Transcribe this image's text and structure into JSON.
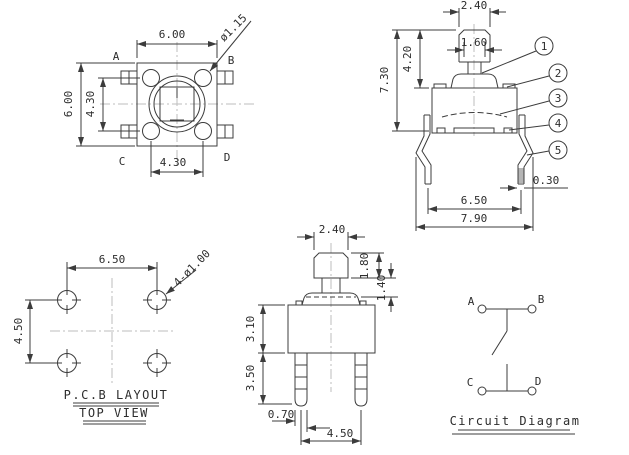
{
  "meta": {
    "background": "#ffffff",
    "line_color": "#3c3c3c",
    "centerline_color": "#bdbdbd"
  },
  "top_view": {
    "dim_width": "6.00",
    "dim_height": "6.00",
    "dim_pin_vertical": "4.30",
    "dim_pin_horizontal": "4.30",
    "button_diameter": "ø1.15",
    "pin_a": "A",
    "pin_b": "B",
    "pin_c": "C",
    "pin_d": "D"
  },
  "side_view": {
    "dim_cap_width": "2.40",
    "dim_stem_width": "1.60",
    "dim_stem_height": "4.20",
    "dim_total_height": "7.30",
    "dim_leg_thickness": "0.30",
    "dim_leg_span": "6.50",
    "dim_total_width": "7.90",
    "callout_1": "1",
    "callout_2": "2",
    "callout_3": "3",
    "callout_4": "4",
    "callout_5": "5"
  },
  "pcb_view": {
    "dim_hole_span_h": "6.50",
    "dim_hole_span_v": "4.50",
    "hole_note": "4-ø1.00",
    "title": "P.C.B LAYOUT",
    "subtitle": "TOP VIEW"
  },
  "front_view": {
    "dim_cap_width": "2.40",
    "dim_cap_height": "1.80",
    "dim_neck_height": "1.40",
    "dim_body_height": "3.10",
    "dim_leg_length": "3.50",
    "dim_leg_width": "0.70",
    "dim_leg_span": "4.50"
  },
  "circuit": {
    "title": "Circuit Diagram",
    "terminal_a": "A",
    "terminal_b": "B",
    "terminal_c": "C",
    "terminal_d": "D"
  }
}
